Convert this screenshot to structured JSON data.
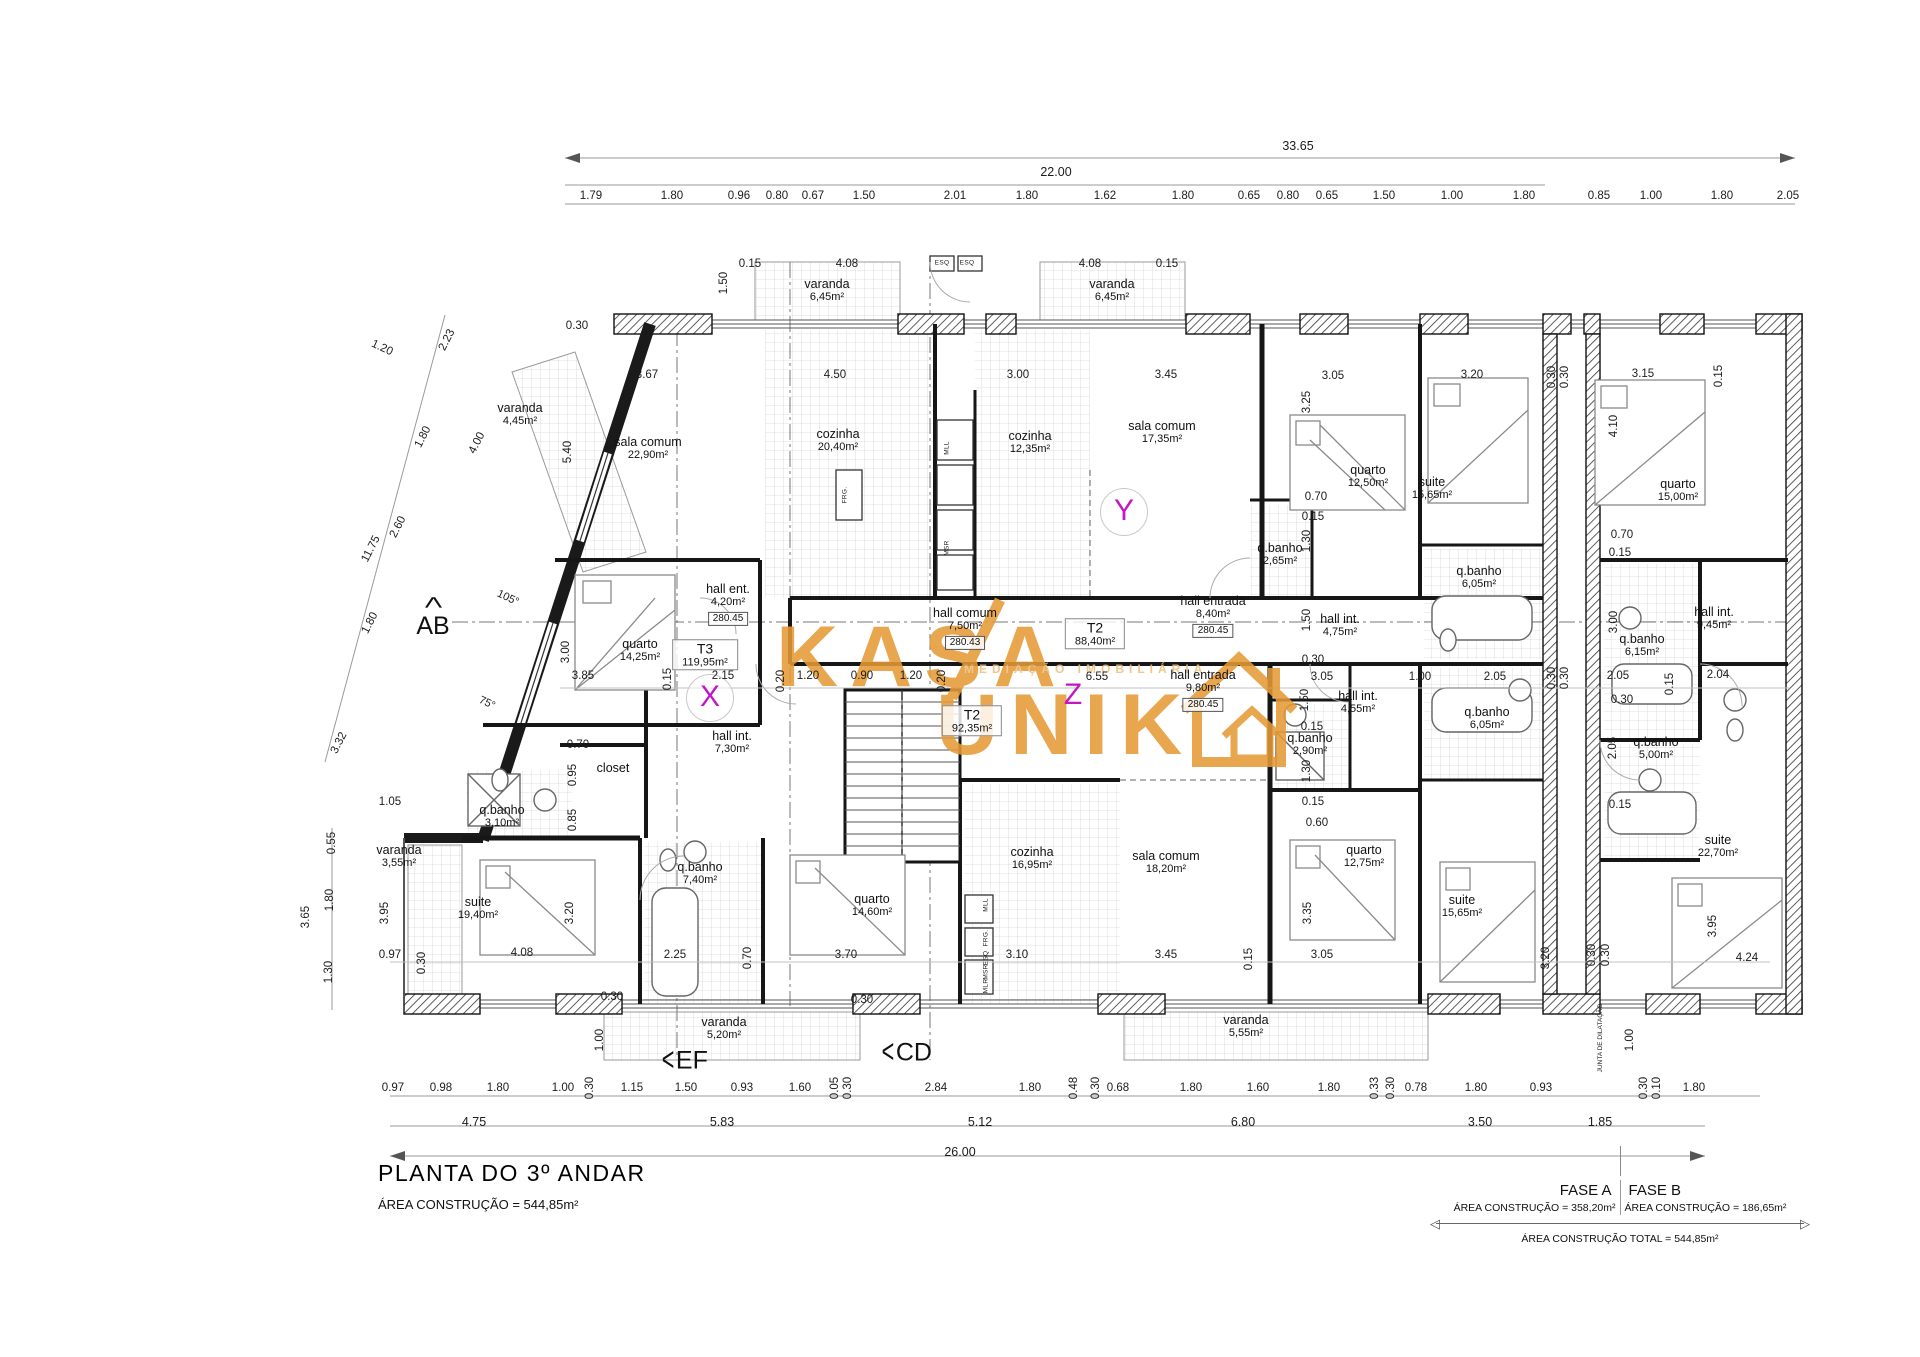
{
  "title_block": {
    "title": "PLANTA DO 3º ANDAR",
    "subtitle": "ÁREA CONSTRUÇÃO = 544,85m²"
  },
  "phase_table": {
    "fase_a_label": "FASE A",
    "fase_b_label": "FASE B",
    "fase_a_area": "ÁREA CONSTRUÇÃO = 358,20m²",
    "fase_b_area": "ÁREA CONSTRUÇÃO = 186,65m²",
    "total": "ÁREA CONSTRUÇÃO TOTAL = 544,85m²",
    "arrow_left": "◁",
    "arrow_right": "▷"
  },
  "watermark": {
    "word1": "KASA",
    "word2": "UNIK",
    "tagline": "MEDIAÇÃO IMOBILIÁRIA",
    "color": "#e59a36"
  },
  "plan": {
    "unit_tags": [
      {
        "t": "T3",
        "a": "119,95m²",
        "x": 705,
        "y": 655
      },
      {
        "t": "T2",
        "a": "88,40m²",
        "x": 1095,
        "y": 634
      },
      {
        "t": "T2",
        "a": "92,35m²",
        "x": 972,
        "y": 721
      }
    ],
    "letters": [
      {
        "t": "X",
        "x": 710,
        "y": 698,
        "c": 1
      },
      {
        "t": "Y",
        "x": 1124,
        "y": 512,
        "c": 1
      },
      {
        "t": "Z",
        "x": 1073,
        "y": 695,
        "c": 0
      }
    ],
    "rooms": [
      {
        "n": "varanda",
        "a": "4,45m²",
        "x": 520,
        "y": 414
      },
      {
        "n": "sala comum",
        "a": "22,90m²",
        "x": 648,
        "y": 448
      },
      {
        "n": "cozinha",
        "a": "20,40m²",
        "x": 838,
        "y": 440
      },
      {
        "n": "varanda",
        "a": "6,45m²",
        "x": 827,
        "y": 290
      },
      {
        "n": "varanda",
        "a": "6,45m²",
        "x": 1112,
        "y": 290
      },
      {
        "n": "cozinha",
        "a": "12,35m²",
        "x": 1030,
        "y": 442
      },
      {
        "n": "sala comum",
        "a": "17,35m²",
        "x": 1162,
        "y": 432
      },
      {
        "n": "quarto",
        "a": "12,50m²",
        "x": 1368,
        "y": 476
      },
      {
        "n": "q.banho",
        "a": "2,65m²",
        "x": 1280,
        "y": 554
      },
      {
        "n": "suite",
        "a": "15,65m²",
        "x": 1432,
        "y": 488
      },
      {
        "n": "q.banho",
        "a": "6,05m²",
        "x": 1479,
        "y": 577
      },
      {
        "n": "quarto",
        "a": "15,00m²",
        "x": 1678,
        "y": 490
      },
      {
        "n": "quarto",
        "a": "14,25m²",
        "x": 640,
        "y": 650
      },
      {
        "n": "hall ent.",
        "a": "4,20m²",
        "x": 728,
        "y": 604,
        "l": "280.45"
      },
      {
        "n": "hall comum",
        "a": "7,50m²",
        "x": 965,
        "y": 628,
        "l": "280.43"
      },
      {
        "n": "hall entrada",
        "a": "8,40m²",
        "x": 1213,
        "y": 616,
        "l": "280.45"
      },
      {
        "n": "hall int.",
        "a": "4,75m²",
        "x": 1340,
        "y": 625
      },
      {
        "n": "hall int.",
        "a": "9,45m²",
        "x": 1714,
        "y": 618
      },
      {
        "n": "q.banho",
        "a": "6,15m²",
        "x": 1642,
        "y": 645
      },
      {
        "n": "hall entrada",
        "a": "9,80m²",
        "x": 1203,
        "y": 690,
        "l": "280.45"
      },
      {
        "n": "hall int.",
        "a": "4,55m²",
        "x": 1358,
        "y": 702
      },
      {
        "n": "q.banho",
        "a": "2,90m²",
        "x": 1310,
        "y": 744
      },
      {
        "n": "q.banho",
        "a": "6,05m²",
        "x": 1487,
        "y": 718
      },
      {
        "n": "q.banho",
        "a": "5,00m²",
        "x": 1656,
        "y": 748
      },
      {
        "n": "hall int.",
        "a": "7,30m²",
        "x": 732,
        "y": 742
      },
      {
        "n": "closet",
        "a": "",
        "x": 613,
        "y": 768
      },
      {
        "n": "q.banho",
        "a": "3,10m²",
        "x": 502,
        "y": 816
      },
      {
        "n": "varanda",
        "a": "3,55m²",
        "x": 399,
        "y": 856
      },
      {
        "n": "suite",
        "a": "19,40m²",
        "x": 478,
        "y": 908
      },
      {
        "n": "q.banho",
        "a": "7,40m²",
        "x": 700,
        "y": 873
      },
      {
        "n": "quarto",
        "a": "14,60m²",
        "x": 872,
        "y": 905
      },
      {
        "n": "cozinha",
        "a": "16,95m²",
        "x": 1032,
        "y": 858
      },
      {
        "n": "sala comum",
        "a": "18,20m²",
        "x": 1166,
        "y": 862
      },
      {
        "n": "quarto",
        "a": "12,75m²",
        "x": 1364,
        "y": 856
      },
      {
        "n": "suite",
        "a": "15,65m²",
        "x": 1462,
        "y": 906
      },
      {
        "n": "suite",
        "a": "22,70m²",
        "x": 1718,
        "y": 846
      },
      {
        "n": "varanda",
        "a": "5,20m²",
        "x": 724,
        "y": 1028
      },
      {
        "n": "varanda",
        "a": "5,55m²",
        "x": 1246,
        "y": 1026
      }
    ],
    "dims": [
      [
        "33.65",
        1298,
        146,
        0,
        1
      ],
      [
        "22.00",
        1056,
        172,
        0,
        1
      ],
      [
        "1.79",
        591,
        196
      ],
      [
        "1.80",
        672,
        196
      ],
      [
        "0.96",
        739,
        196
      ],
      [
        "0.80",
        777,
        196
      ],
      [
        "0.67",
        813,
        196
      ],
      [
        "1.50",
        864,
        196
      ],
      [
        "2.01",
        955,
        196
      ],
      [
        "1.80",
        1027,
        196
      ],
      [
        "1.62",
        1105,
        196
      ],
      [
        "1.80",
        1183,
        196
      ],
      [
        "0.65",
        1249,
        196
      ],
      [
        "0.80",
        1288,
        196
      ],
      [
        "0.65",
        1327,
        196
      ],
      [
        "1.50",
        1384,
        196
      ],
      [
        "1.00",
        1452,
        196
      ],
      [
        "1.80",
        1524,
        196
      ],
      [
        "0.85",
        1599,
        196
      ],
      [
        "1.00",
        1651,
        196
      ],
      [
        "1.80",
        1722,
        196
      ],
      [
        "2.05",
        1788,
        196
      ],
      [
        "0.97",
        393,
        1088
      ],
      [
        "0.98",
        441,
        1088
      ],
      [
        "1.80",
        498,
        1088
      ],
      [
        "1.00",
        563,
        1088
      ],
      [
        "0.30",
        590,
        1088,
        1
      ],
      [
        "1.15",
        632,
        1088
      ],
      [
        "1.50",
        686,
        1088
      ],
      [
        "0.93",
        742,
        1088
      ],
      [
        "1.60",
        800,
        1088
      ],
      [
        "0.05",
        835,
        1088,
        1
      ],
      [
        "0.30",
        848,
        1088,
        1
      ],
      [
        "2.84",
        936,
        1088
      ],
      [
        "1.80",
        1030,
        1088
      ],
      [
        "0.48",
        1074,
        1088,
        1
      ],
      [
        "0.30",
        1096,
        1088,
        1
      ],
      [
        "0.68",
        1118,
        1088
      ],
      [
        "1.80",
        1191,
        1088
      ],
      [
        "1.60",
        1258,
        1088
      ],
      [
        "1.80",
        1329,
        1088
      ],
      [
        "0.33",
        1375,
        1088,
        1
      ],
      [
        "0.30",
        1391,
        1088,
        1
      ],
      [
        "0.78",
        1416,
        1088
      ],
      [
        "1.80",
        1476,
        1088
      ],
      [
        "0.93",
        1541,
        1088
      ],
      [
        "0.30",
        1644,
        1088,
        1
      ],
      [
        "0.10",
        1657,
        1088,
        1
      ],
      [
        "1.80",
        1694,
        1088
      ],
      [
        "4.75",
        474,
        1122,
        0,
        1
      ],
      [
        "5.83",
        722,
        1122,
        0,
        1
      ],
      [
        "5.12",
        980,
        1122,
        0,
        1
      ],
      [
        "6.80",
        1243,
        1122,
        0,
        1
      ],
      [
        "3.50",
        1480,
        1122,
        0,
        1
      ],
      [
        "1.85",
        1600,
        1122,
        0,
        1
      ],
      [
        "26.00",
        960,
        1152,
        0,
        1
      ],
      [
        "2.23",
        447,
        340,
        2
      ],
      [
        "1.80",
        423,
        437,
        2
      ],
      [
        "2.60",
        398,
        527,
        2
      ],
      [
        "11.75",
        371,
        549,
        2
      ],
      [
        "1.80",
        370,
        623,
        2
      ],
      [
        "3.32",
        339,
        743,
        2
      ],
      [
        "4.00",
        477,
        443,
        2
      ],
      [
        "1.20",
        382,
        348,
        3
      ],
      [
        "1.05",
        390,
        802
      ],
      [
        "0.55",
        332,
        843,
        1
      ],
      [
        "1.80",
        330,
        900,
        1
      ],
      [
        "1.30",
        329,
        972,
        1
      ],
      [
        "3.65",
        306,
        917,
        1
      ],
      [
        "3.95",
        385,
        913,
        1
      ],
      [
        "0.97",
        390,
        955
      ],
      [
        "0.30",
        422,
        963,
        1
      ],
      [
        "1.00",
        600,
        1040,
        1
      ],
      [
        "1.00",
        1630,
        1040,
        1
      ],
      [
        "0.30",
        577,
        326
      ],
      [
        "3.67",
        647,
        375
      ],
      [
        "4.50",
        835,
        375
      ],
      [
        "5.40",
        568,
        452,
        1
      ],
      [
        "0.15",
        750,
        264
      ],
      [
        "4.08",
        847,
        264
      ],
      [
        "1.50",
        724,
        283,
        1
      ],
      [
        "4.08",
        1090,
        264
      ],
      [
        "0.15",
        1167,
        264
      ],
      [
        "3.00",
        1018,
        375
      ],
      [
        "3.45",
        1166,
        375
      ],
      [
        "3.05",
        1333,
        376
      ],
      [
        "3.25",
        1307,
        402,
        1
      ],
      [
        "0.70",
        1316,
        497
      ],
      [
        "0.15",
        1313,
        517
      ],
      [
        "1.30",
        1307,
        541,
        1
      ],
      [
        "3.20",
        1472,
        375
      ],
      [
        "0.30",
        1552,
        377,
        1
      ],
      [
        "0.30",
        1565,
        377,
        1
      ],
      [
        "3.15",
        1643,
        374
      ],
      [
        "0.15",
        1719,
        376,
        1
      ],
      [
        "4.10",
        1614,
        426,
        1
      ],
      [
        "0.70",
        1622,
        535
      ],
      [
        "0.15",
        1620,
        553
      ],
      [
        "3.85",
        583,
        676
      ],
      [
        "0.15",
        668,
        679,
        1
      ],
      [
        "2.15",
        723,
        676
      ],
      [
        "0.20",
        781,
        681,
        1
      ],
      [
        "1.20",
        808,
        676
      ],
      [
        "0.90",
        862,
        676
      ],
      [
        "1.20",
        911,
        676
      ],
      [
        "0.20",
        942,
        681,
        1
      ],
      [
        "6.55",
        1097,
        677
      ],
      [
        "0.30",
        1313,
        660
      ],
      [
        "3.05",
        1322,
        677
      ],
      [
        "1.00",
        1420,
        677
      ],
      [
        "2.05",
        1495,
        677
      ],
      [
        "0.30",
        1552,
        678,
        1
      ],
      [
        "0.30",
        1565,
        678,
        1
      ],
      [
        "2.05",
        1618,
        676
      ],
      [
        "2.04",
        1718,
        675
      ],
      [
        "0.15",
        1670,
        684,
        1
      ],
      [
        "3.00",
        1614,
        622,
        1
      ],
      [
        "3.00",
        566,
        652,
        1
      ],
      [
        "1.50",
        1307,
        620,
        1
      ],
      [
        "1.50",
        1305,
        700,
        1
      ],
      [
        "0.15",
        1312,
        727
      ],
      [
        "1.30",
        1307,
        771,
        1
      ],
      [
        "0.15",
        1313,
        802
      ],
      [
        "0.60",
        1317,
        823
      ],
      [
        "3.35",
        1308,
        913,
        1
      ],
      [
        "0.30",
        1622,
        700
      ],
      [
        "2.05",
        1613,
        748,
        1
      ],
      [
        "0.15",
        1620,
        805
      ],
      [
        "4.08",
        522,
        953
      ],
      [
        "2.25",
        675,
        955
      ],
      [
        "0.70",
        748,
        958,
        1
      ],
      [
        "3.70",
        846,
        955
      ],
      [
        "3.10",
        1017,
        955
      ],
      [
        "3.45",
        1166,
        955
      ],
      [
        "0.15",
        1249,
        959,
        1
      ],
      [
        "3.05",
        1322,
        955
      ],
      [
        "3.20",
        1546,
        958,
        1
      ],
      [
        "3.95",
        1713,
        926,
        1
      ],
      [
        "4.24",
        1747,
        958
      ],
      [
        "0.30",
        1592,
        955,
        1
      ],
      [
        "0.30",
        1606,
        955,
        1
      ],
      [
        "3.20",
        570,
        913,
        1
      ],
      [
        "0.85",
        573,
        820,
        1
      ],
      [
        "0.95",
        573,
        775,
        1
      ],
      [
        "0.70",
        578,
        745
      ],
      [
        "0.30",
        612,
        997
      ],
      [
        "0.30",
        862,
        1000
      ]
    ],
    "markers": [
      {
        "t": "AB",
        "x": 433,
        "y": 614,
        "d": "up"
      },
      {
        "t": "EF",
        "x": 684,
        "y": 1060,
        "d": "left"
      },
      {
        "t": "CD",
        "x": 906,
        "y": 1052,
        "d": "left"
      }
    ],
    "angles": [
      [
        "105°",
        508,
        598
      ],
      [
        "75°",
        487,
        703
      ]
    ],
    "appliances": [
      [
        "ESQ",
        942,
        263,
        0
      ],
      [
        "ESQ",
        967,
        263,
        0
      ],
      [
        "MLL",
        947,
        448,
        1
      ],
      [
        "MSR",
        947,
        548,
        1
      ],
      [
        "FRG.",
        845,
        495,
        1
      ],
      [
        "MLL",
        986,
        905,
        1
      ],
      [
        "FRG.",
        986,
        938,
        1
      ],
      [
        "ESQ",
        986,
        958,
        1
      ],
      [
        "MSR",
        986,
        972,
        1
      ],
      [
        "MLR",
        986,
        986,
        1
      ]
    ],
    "joint": {
      "text": "JUNTA DE DILATAÇÃO",
      "x": 1601,
      "y": 1038
    },
    "caret": "<"
  }
}
